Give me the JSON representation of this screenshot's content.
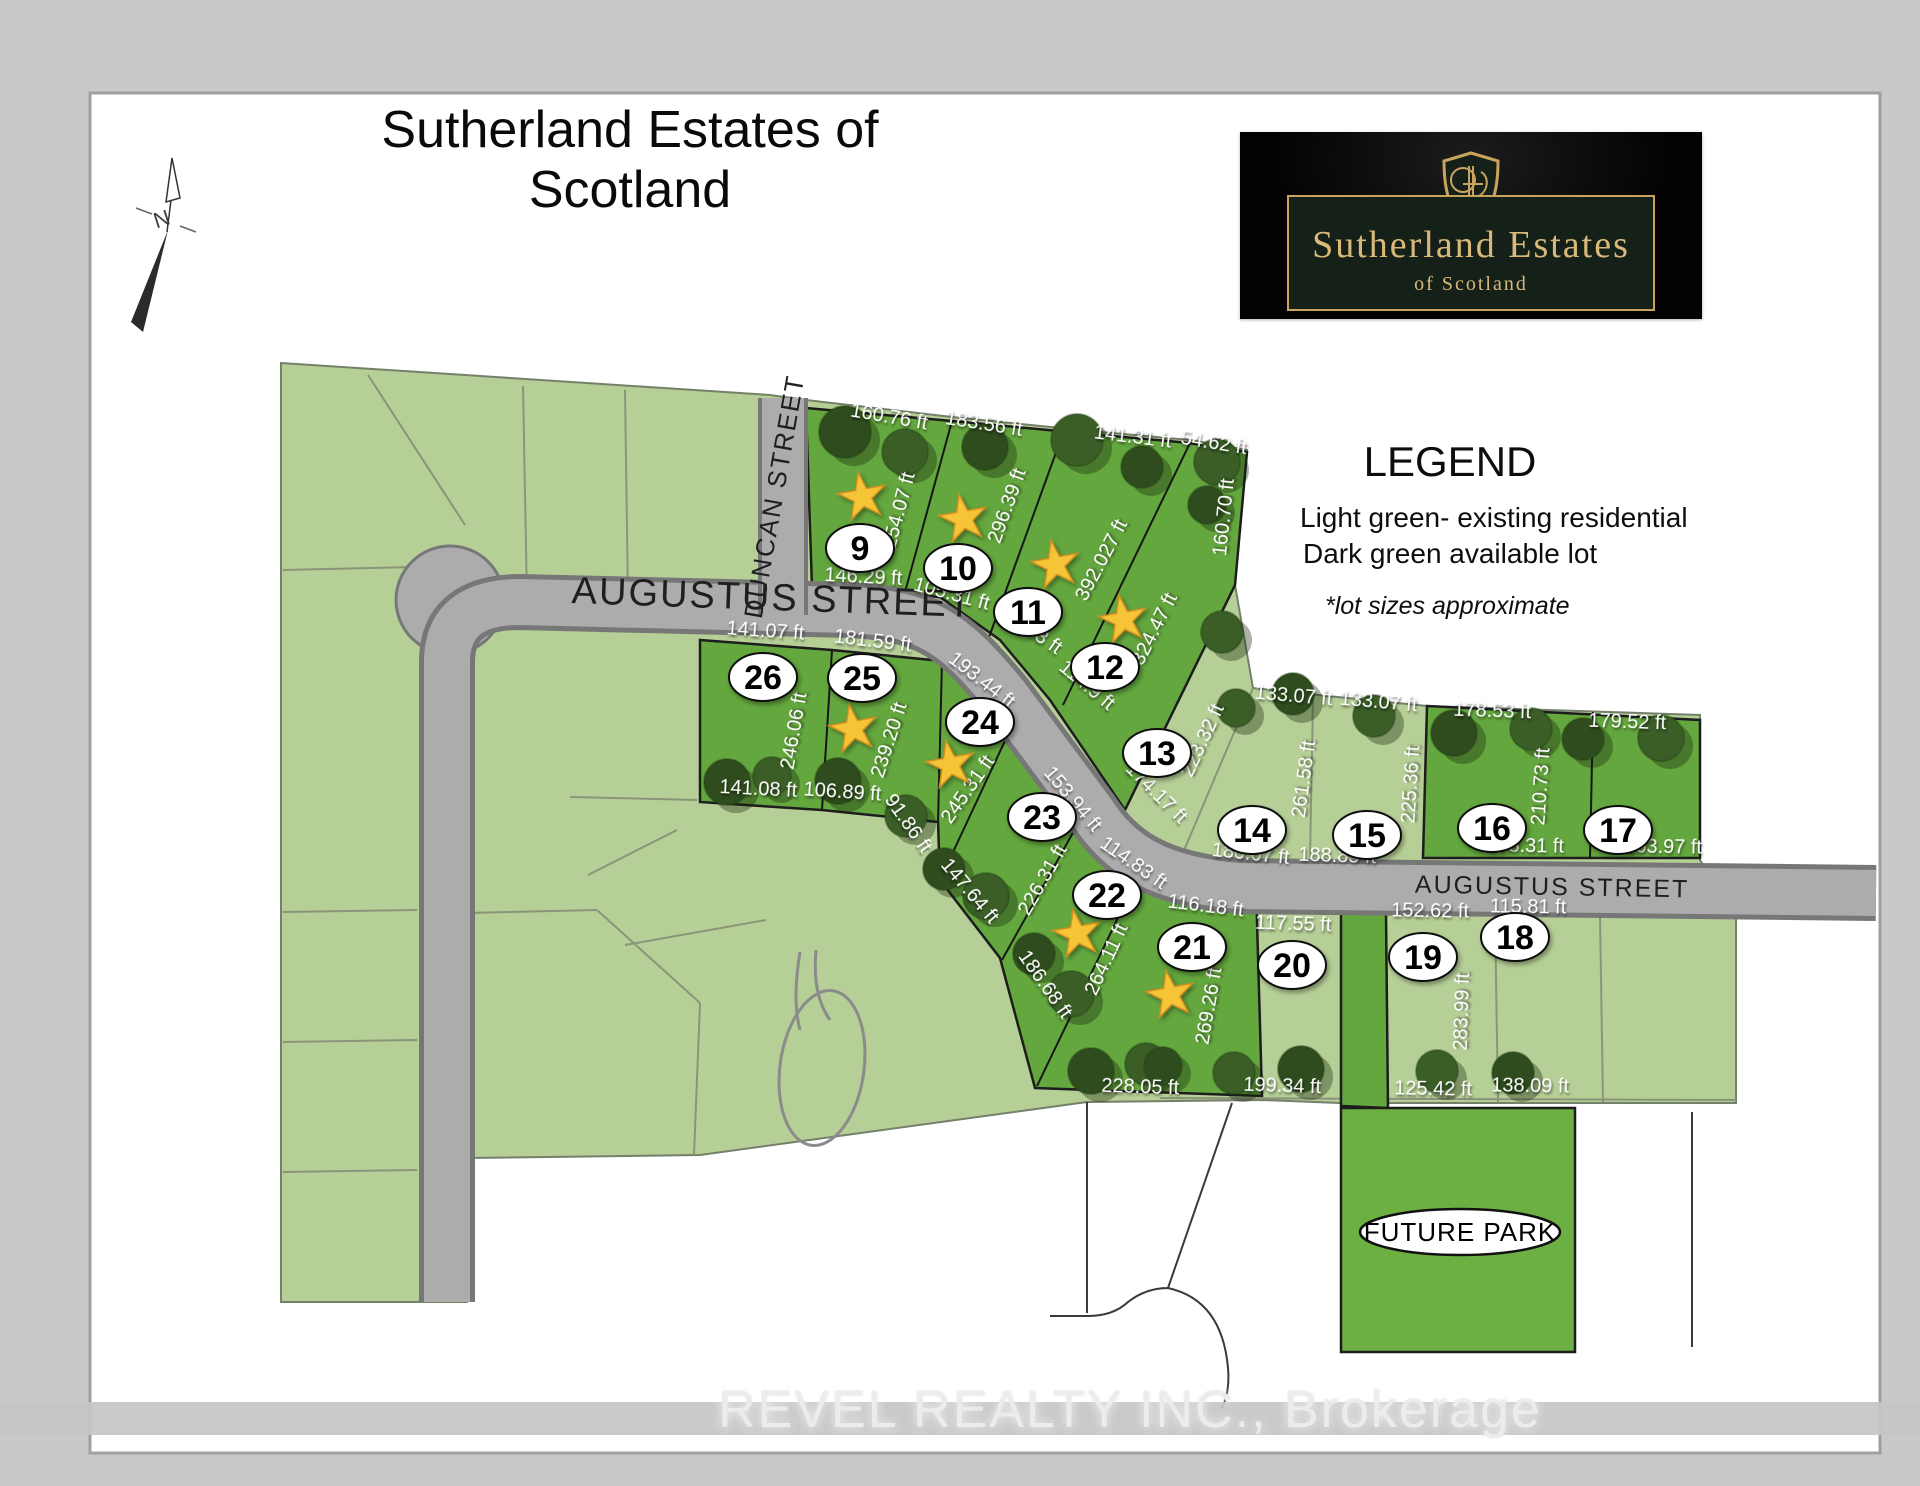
{
  "title": "Sutherland Estates of Scotland",
  "north_label": "N",
  "logo": {
    "line1": "Sutherland Estates",
    "line2": "of Scotland"
  },
  "legend": {
    "title": "LEGEND",
    "item_light": "Light green- existing residential",
    "item_dark": "Dark green available lot",
    "note": "*lot sizes approximate"
  },
  "watermark": "REVEL REALTY INC., Brokerage",
  "colors": {
    "light_green": "#b6cf96",
    "dark_green": "#64a73e",
    "road_gray": "#acacac",
    "star_gold": "#f6c437",
    "logo_gold": "#c9a45c",
    "logo_panel_green": "#152019"
  },
  "map": {
    "streets": [
      {
        "name": "DUNCAN STREET",
        "x": 783,
        "y": 498,
        "rot": -80,
        "size": 26,
        "spacing": 1
      },
      {
        "name": "AUGUSTUS STREET",
        "x": 772,
        "y": 610,
        "rot": 2,
        "size": 38,
        "spacing": 2
      },
      {
        "name": "AUGUSTUS STREET",
        "x": 1552,
        "y": 895,
        "rot": 1,
        "size": 25,
        "spacing": 2
      }
    ],
    "future_park": {
      "label": "FUTURE PARK",
      "x": 1460,
      "y": 1232
    },
    "lots": [
      {
        "number": "9",
        "type": "available",
        "star": {
          "x": 862,
          "y": 495
        },
        "oval": {
          "x": 860,
          "y": 548
        },
        "dims": [
          {
            "t": "160.76 ft",
            "x": 888,
            "y": 423,
            "r": 10
          },
          {
            "t": "254.07 ft",
            "x": 905,
            "y": 512,
            "r": -75
          },
          {
            "t": "146.29 ft",
            "x": 863,
            "y": 583,
            "r": 3
          }
        ]
      },
      {
        "number": "10",
        "type": "available",
        "star": {
          "x": 963,
          "y": 517
        },
        "oval": {
          "x": 958,
          "y": 568
        },
        "dims": [
          {
            "t": "183.56 ft",
            "x": 983,
            "y": 430,
            "r": 9
          },
          {
            "t": "296.39 ft",
            "x": 1013,
            "y": 508,
            "r": -70
          },
          {
            "t": "105.31 ft",
            "x": 950,
            "y": 600,
            "r": 15
          }
        ]
      },
      {
        "number": "11",
        "type": "available",
        "star": {
          "x": 1055,
          "y": 563
        },
        "oval": {
          "x": 1028,
          "y": 612
        },
        "dims": [
          {
            "t": "141.31 ft",
            "x": 1132,
            "y": 443,
            "r": 7
          },
          {
            "t": "392.027 ft",
            "x": 1107,
            "y": 563,
            "r": -62
          },
          {
            "t": "114.83 ft",
            "x": 1025,
            "y": 633,
            "r": 35
          }
        ]
      },
      {
        "number": "12",
        "type": "available",
        "star": {
          "x": 1123,
          "y": 618
        },
        "oval": {
          "x": 1105,
          "y": 667
        },
        "dims": [
          {
            "t": "54.62 ft",
            "x": 1213,
            "y": 449,
            "r": 9
          },
          {
            "t": "160.70 ft",
            "x": 1230,
            "y": 518,
            "r": -84
          },
          {
            "t": "324.47 ft",
            "x": 1160,
            "y": 632,
            "r": -63
          },
          {
            "t": "114.9 ft",
            "x": 1083,
            "y": 690,
            "r": 40
          }
        ]
      },
      {
        "number": "13",
        "type": "existing",
        "star": null,
        "oval": {
          "x": 1157,
          "y": 753
        },
        "dims": [
          {
            "t": "223.32 ft",
            "x": 1208,
            "y": 743,
            "r": -65
          },
          {
            "t": "174.17 ft",
            "x": 1152,
            "y": 797,
            "r": 45
          }
        ]
      },
      {
        "number": "14",
        "type": "existing",
        "star": null,
        "oval": {
          "x": 1252,
          "y": 830
        },
        "dims": [
          {
            "t": "133.07 ft",
            "x": 1293,
            "y": 702,
            "r": 5
          },
          {
            "t": "261.58 ft",
            "x": 1310,
            "y": 780,
            "r": -82
          },
          {
            "t": "180.67 ft",
            "x": 1250,
            "y": 860,
            "r": 6
          }
        ]
      },
      {
        "number": "15",
        "type": "existing",
        "star": null,
        "oval": {
          "x": 1367,
          "y": 835
        },
        "dims": [
          {
            "t": "133.07 ft",
            "x": 1378,
            "y": 708,
            "r": 5
          },
          {
            "t": "225.36 ft",
            "x": 1417,
            "y": 785,
            "r": -86
          },
          {
            "t": "188.85 ft",
            "x": 1337,
            "y": 862,
            "r": 2
          }
        ]
      },
      {
        "number": "16",
        "type": "available",
        "star": null,
        "oval": {
          "x": 1492,
          "y": 828
        },
        "dims": [
          {
            "t": "178.53 ft",
            "x": 1492,
            "y": 717,
            "r": 2
          },
          {
            "t": "210.73 ft",
            "x": 1547,
            "y": 787,
            "r": -86
          },
          {
            "t": "178.31 ft",
            "x": 1525,
            "y": 852,
            "r": 1
          }
        ]
      },
      {
        "number": "17",
        "type": "available",
        "star": null,
        "oval": {
          "x": 1618,
          "y": 830
        },
        "dims": [
          {
            "t": "179.52 ft",
            "x": 1627,
            "y": 728,
            "r": 2
          },
          {
            "t": "163.97 ft",
            "x": 1663,
            "y": 853,
            "r": 1
          }
        ]
      },
      {
        "number": "18",
        "type": "existing",
        "star": null,
        "oval": {
          "x": 1515,
          "y": 937
        },
        "dims": [
          {
            "t": "115.81 ft",
            "x": 1528,
            "y": 913,
            "r": 1
          },
          {
            "t": "138.09 ft",
            "x": 1530,
            "y": 1092,
            "r": 1
          }
        ]
      },
      {
        "number": "19",
        "type": "existing",
        "star": null,
        "oval": {
          "x": 1423,
          "y": 957
        },
        "dims": [
          {
            "t": "152.62 ft",
            "x": 1430,
            "y": 917,
            "r": 1
          },
          {
            "t": "283.99 ft",
            "x": 1468,
            "y": 1012,
            "r": -88
          },
          {
            "t": "125.42 ft",
            "x": 1433,
            "y": 1095,
            "r": 1
          }
        ]
      },
      {
        "number": "20",
        "type": "existing",
        "star": null,
        "oval": {
          "x": 1292,
          "y": 965
        },
        "dims": [
          {
            "t": "117.55 ft",
            "x": 1293,
            "y": 930,
            "r": 2
          },
          {
            "t": "199.34 ft",
            "x": 1282,
            "y": 1092,
            "r": 2
          }
        ]
      },
      {
        "number": "21",
        "type": "available",
        "star": {
          "x": 1170,
          "y": 993
        },
        "oval": {
          "x": 1192,
          "y": 947
        },
        "dims": [
          {
            "t": "116.18 ft",
            "x": 1205,
            "y": 912,
            "r": 7
          },
          {
            "t": "269.26 ft",
            "x": 1215,
            "y": 1007,
            "r": -80
          },
          {
            "t": "228.05 ft",
            "x": 1140,
            "y": 1093,
            "r": 2
          }
        ]
      },
      {
        "number": "22",
        "type": "available",
        "star": {
          "x": 1077,
          "y": 932
        },
        "oval": {
          "x": 1107,
          "y": 895
        },
        "dims": [
          {
            "t": "114.83 ft",
            "x": 1130,
            "y": 868,
            "r": 35
          },
          {
            "t": "264.11 ft",
            "x": 1112,
            "y": 962,
            "r": -65
          },
          {
            "t": "186.68 ft",
            "x": 1040,
            "y": 988,
            "r": 55
          }
        ]
      },
      {
        "number": "23",
        "type": "available",
        "star": null,
        "oval": {
          "x": 1042,
          "y": 817
        },
        "dims": [
          {
            "t": "153.94 ft",
            "x": 1068,
            "y": 803,
            "r": 50
          },
          {
            "t": "226.31 ft",
            "x": 1048,
            "y": 883,
            "r": -60
          },
          {
            "t": "147.64 ft",
            "x": 965,
            "y": 895,
            "r": 50
          }
        ]
      },
      {
        "number": "24",
        "type": "available",
        "star": {
          "x": 950,
          "y": 763
        },
        "oval": {
          "x": 980,
          "y": 722
        },
        "dims": [
          {
            "t": "193.44 ft",
            "x": 978,
            "y": 685,
            "r": 38
          },
          {
            "t": "245.31 ft",
            "x": 973,
            "y": 793,
            "r": -55
          },
          {
            "t": "91.86 ft",
            "x": 903,
            "y": 827,
            "r": 55
          }
        ]
      },
      {
        "number": "25",
        "type": "available",
        "star": {
          "x": 853,
          "y": 727
        },
        "oval": {
          "x": 862,
          "y": 678
        },
        "dims": [
          {
            "t": "181.59 ft",
            "x": 872,
            "y": 647,
            "r": 7
          },
          {
            "t": "239.20 ft",
            "x": 895,
            "y": 742,
            "r": -72
          },
          {
            "t": "106.89 ft",
            "x": 842,
            "y": 798,
            "r": 4
          }
        ]
      },
      {
        "number": "26",
        "type": "available",
        "star": null,
        "oval": {
          "x": 763,
          "y": 677
        },
        "dims": [
          {
            "t": "141.07 ft",
            "x": 765,
            "y": 637,
            "r": 4
          },
          {
            "t": "246.06 ft",
            "x": 800,
            "y": 732,
            "r": -80
          },
          {
            "t": "141.08 ft",
            "x": 758,
            "y": 795,
            "r": 3
          }
        ]
      }
    ]
  }
}
